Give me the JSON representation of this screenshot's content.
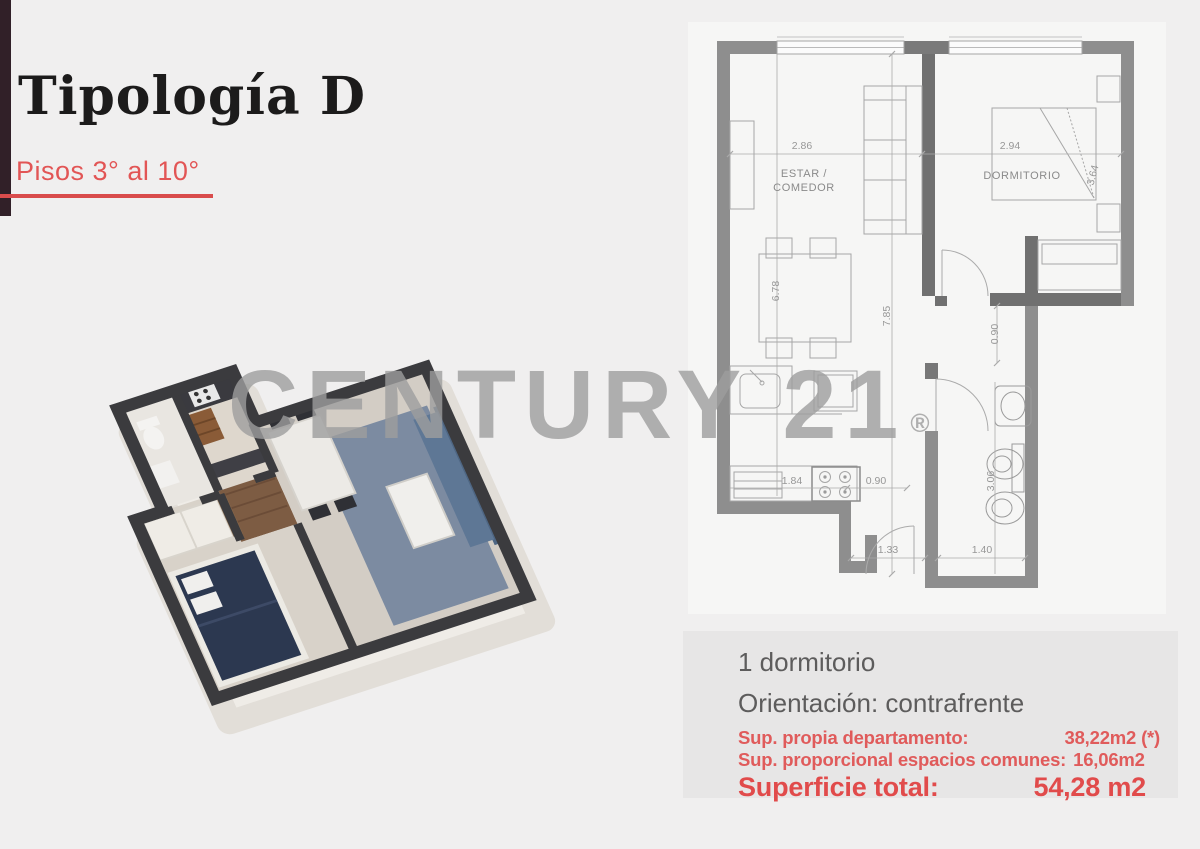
{
  "header": {
    "title": "Tipología D",
    "subtitle": "Pisos 3° al 10°"
  },
  "watermark": {
    "text": "CENTURY 21",
    "mark": "®"
  },
  "plan": {
    "labels": {
      "estar_line1": "ESTAR /",
      "estar_line2": "COMEDOR",
      "dormitorio": "DORMITORIO"
    },
    "dims": {
      "estar_width": "2.86",
      "dorm_width": "2.94",
      "dorm_depth": "3.64",
      "estar_depth": "6.78",
      "total_depth": "7.85",
      "hall_width": "0.90",
      "kitchen_run": "1.84",
      "kitchen_pass": "0.90",
      "bath_depth": "3.06",
      "entry_width": "1.33",
      "bath_width": "1.40"
    }
  },
  "details": {
    "bedrooms": "1 dormitorio",
    "orientation": "Orientación: contrafrente",
    "own_area_label": "Sup. propia departamento:",
    "own_area_value": "38,22m2 (*)",
    "common_area_label": "Sup. proporcional espacios comunes:",
    "common_area_value": "16,06m2",
    "total_label": "Superficie total:",
    "total_value": "54,28 m2"
  },
  "colors": {
    "accent_red": "#d94c4c",
    "subtitle_red": "#e25555",
    "area_red": "#e05b5b",
    "stripe_maroon": "#312028",
    "title_black": "#1c1b1b",
    "info_gray": "#5d5c5c",
    "plan_wall_gray": "#8e8e8e",
    "watermark_gray": "#9e9e9e"
  }
}
